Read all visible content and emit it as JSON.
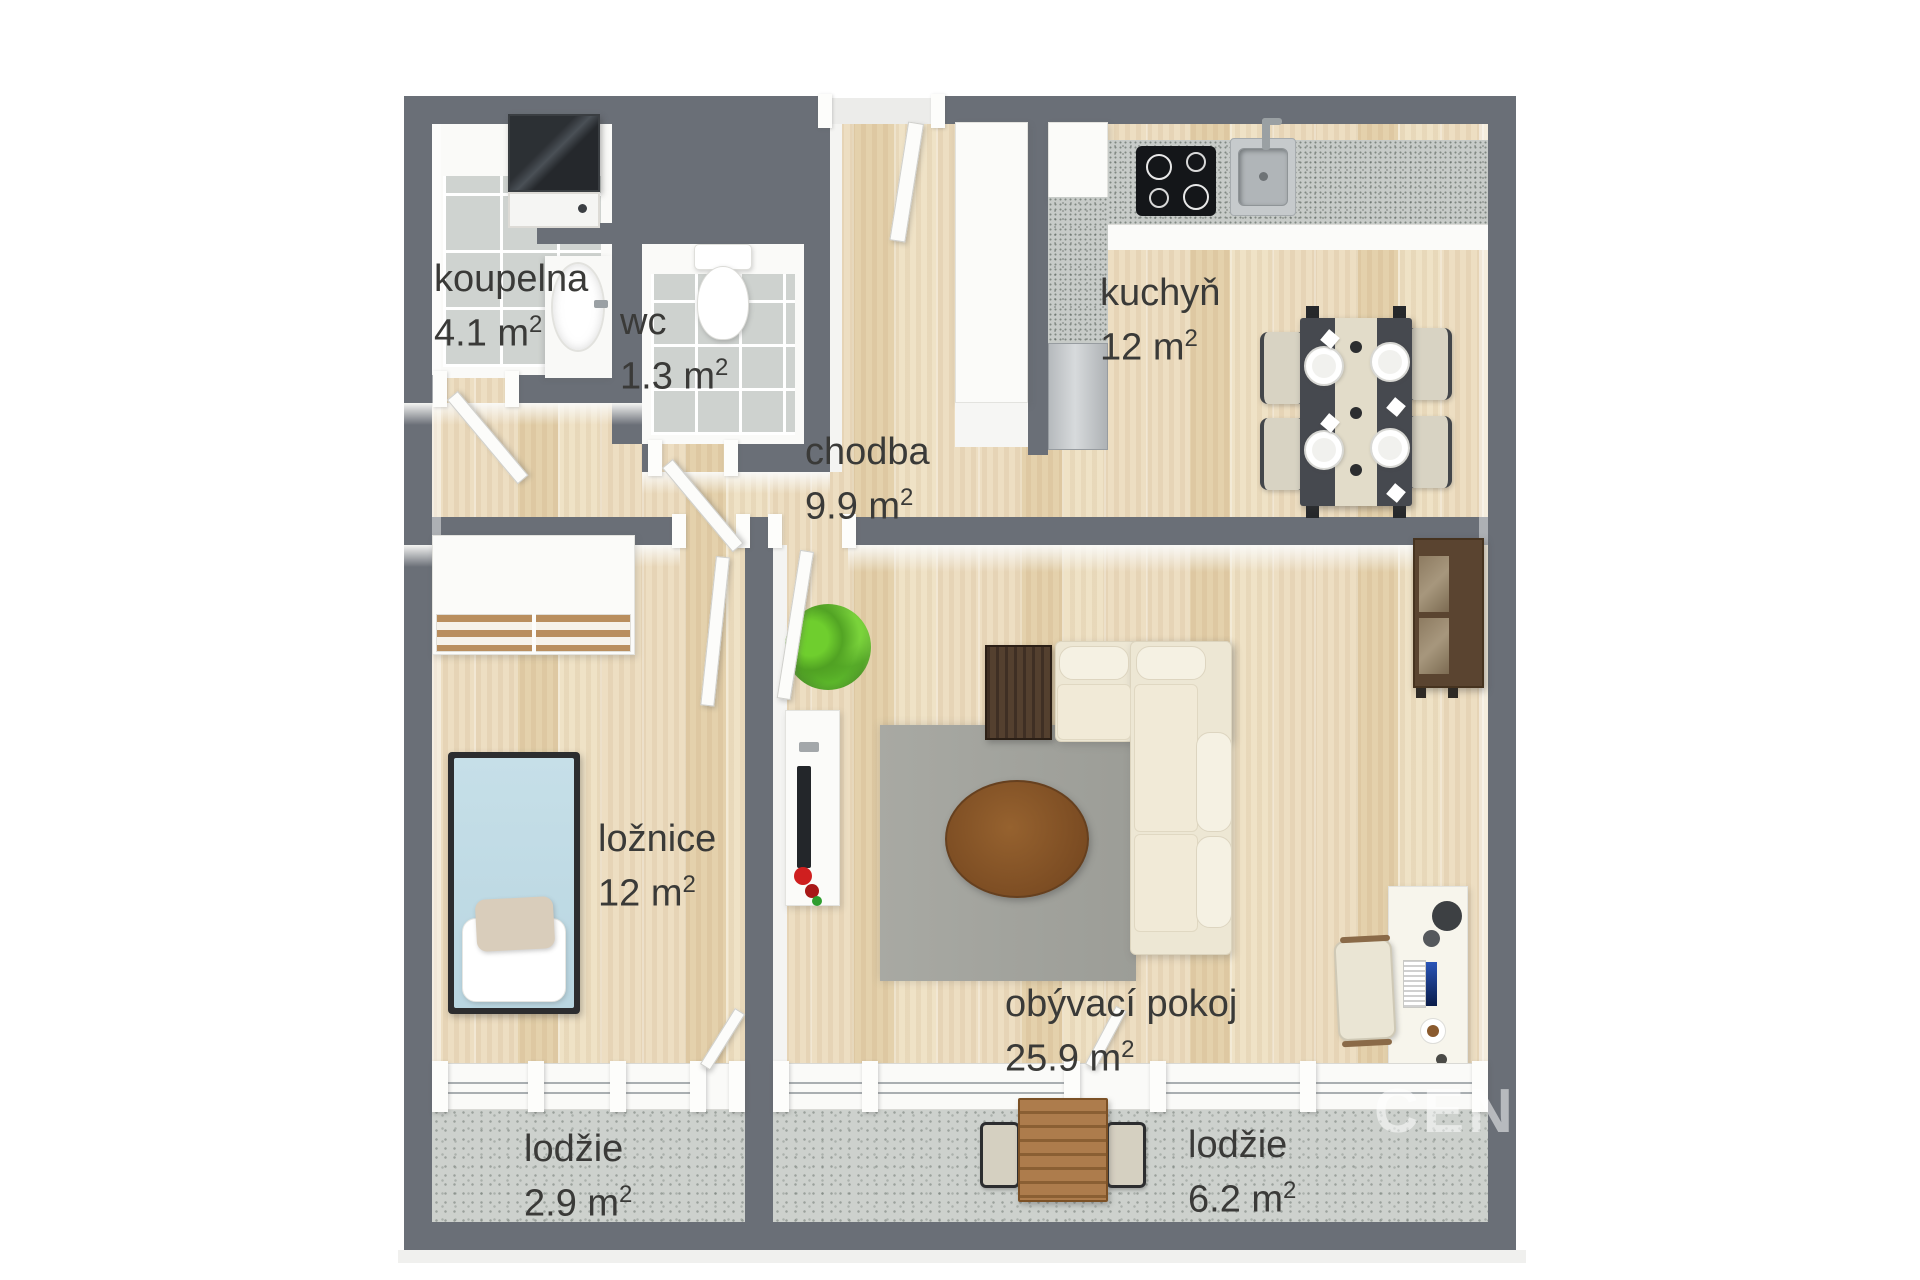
{
  "watermark": "CENT",
  "rooms": [
    {
      "id": "koupelna",
      "name": "koupelna",
      "area": "4.1 m",
      "sup": "2"
    },
    {
      "id": "wc",
      "name": "wc",
      "area": "1.3 m",
      "sup": "2"
    },
    {
      "id": "chodba",
      "name": "chodba",
      "area": "9.9 m",
      "sup": "2"
    },
    {
      "id": "kuchyn",
      "name": "kuchyň",
      "area": "12 m",
      "sup": "2"
    },
    {
      "id": "loznice",
      "name": "ložnice",
      "area": "12 m",
      "sup": "2"
    },
    {
      "id": "obyvaci-pokoj",
      "name": "obývací pokoj",
      "area": "25.9 m",
      "sup": "2"
    },
    {
      "id": "lodzie-mala",
      "name": "lodžie",
      "area": "2.9 m",
      "sup": "2"
    },
    {
      "id": "lodzie-velka",
      "name": "lodžie",
      "area": "6.2 m",
      "sup": "2"
    }
  ],
  "palette": {
    "wall": "#6a6f77",
    "wood_floor": "#e9d7b5",
    "tile_floor": "#cfd3d0",
    "loggia_floor": "#cdd1cd",
    "sofa": "#ede7d4",
    "label_text": "#3a3a38"
  }
}
